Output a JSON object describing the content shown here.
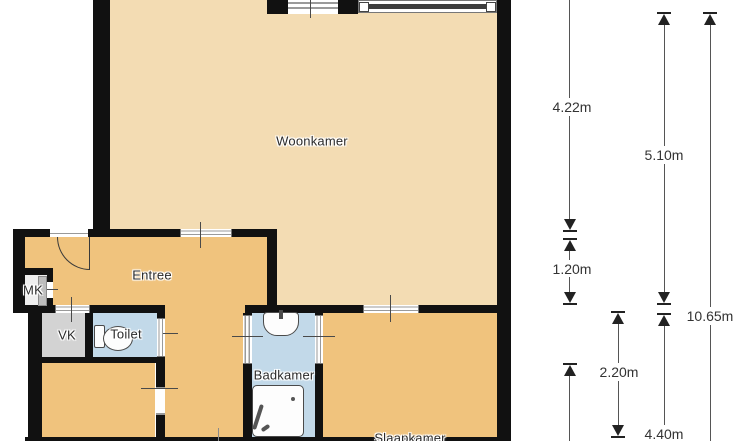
{
  "floorplan": {
    "type": "apartment-floor-plan",
    "rooms": {
      "woonkamer": "Woonkamer",
      "entree": "Entree",
      "mk": "MK",
      "vk": "VK",
      "toilet": "Toilet",
      "badkamer": "Badkamer",
      "slaapkamer": "Slaapkamer"
    },
    "fixtures": [
      "toilet",
      "sink",
      "shower",
      "door-arc",
      "windows"
    ],
    "colors": {
      "wall": "#111111",
      "woonkamer_fill": "#F3DCB3",
      "entree_slaapkamer_fill": "#F0C37D",
      "wet_room_fill": "#C2D9E9",
      "vk_fill": "#D3D3D3",
      "mk_fill": "#EFEFEF",
      "dimension_line": "#555555",
      "label_text": "#2B2B2B"
    }
  },
  "dimensions": {
    "left_top": "4.22m",
    "left_mid": "1.20m",
    "inner_room": "2.20m",
    "mid_top": "5.10m",
    "mid_bottom": "4.40m",
    "right_total": "10.65m"
  }
}
